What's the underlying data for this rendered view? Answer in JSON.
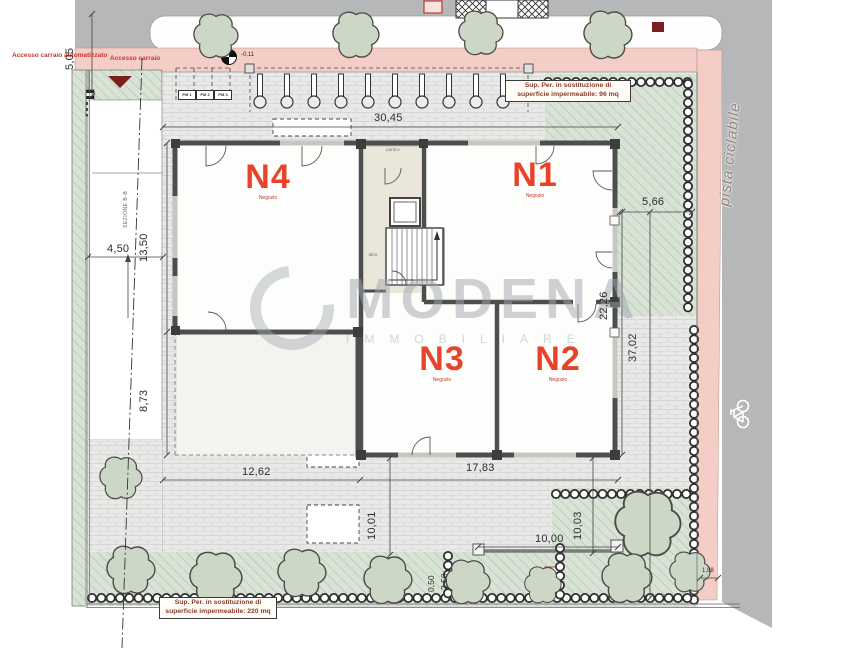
{
  "labels": {
    "access_auto": "Accesso carraio automatizzato",
    "access": "Accesso carraio",
    "bike_path": "pista ciclabile",
    "section": "SEZIONE B-B",
    "level": "-0.11",
    "portico": "portico",
    "atrio": "atrio"
  },
  "parking": [
    "PM 1",
    "PM 2",
    "PM 3"
  ],
  "units": [
    {
      "id": "N1",
      "type": "Negozio"
    },
    {
      "id": "N2",
      "type": "Negozio"
    },
    {
      "id": "N3",
      "type": "Negozio"
    },
    {
      "id": "N4",
      "type": "Negozio"
    }
  ],
  "notes": {
    "top": "Sup. Per. in sostituzione di superficie impermeabile: 96 mq",
    "bottom": "Sup. Per. in sostituzione di superficie impermeabile: 220 mq"
  },
  "dimensions": {
    "street_width": "5,05",
    "top_width": "30,45",
    "drive_width": "4,50",
    "side_upper": "13,50",
    "side_lower": "8,73",
    "right_setback": "5,66",
    "right_inner": "22,26",
    "right_total": "37,02",
    "bottom_left": "12,62",
    "bottom_right": "17,83",
    "south_left": "10,01",
    "fence_length": "10,00",
    "south_right": "10,03",
    "hedge_a": "0,50",
    "hedge_b": "2,50",
    "corner": "1,88"
  },
  "watermark": {
    "name": "MODENA",
    "tagline": "IMMOBILIARE"
  },
  "colors": {
    "road": "#b5b7b9",
    "bike_lane": "#f4cdc6",
    "paving": "#e9e9e8",
    "green": "#d9e3d5",
    "wall": "#4e4e4e",
    "unit_label": "#e8432a",
    "annotation_red": "#c23b2e",
    "dark_red": "#7e1d1d"
  }
}
